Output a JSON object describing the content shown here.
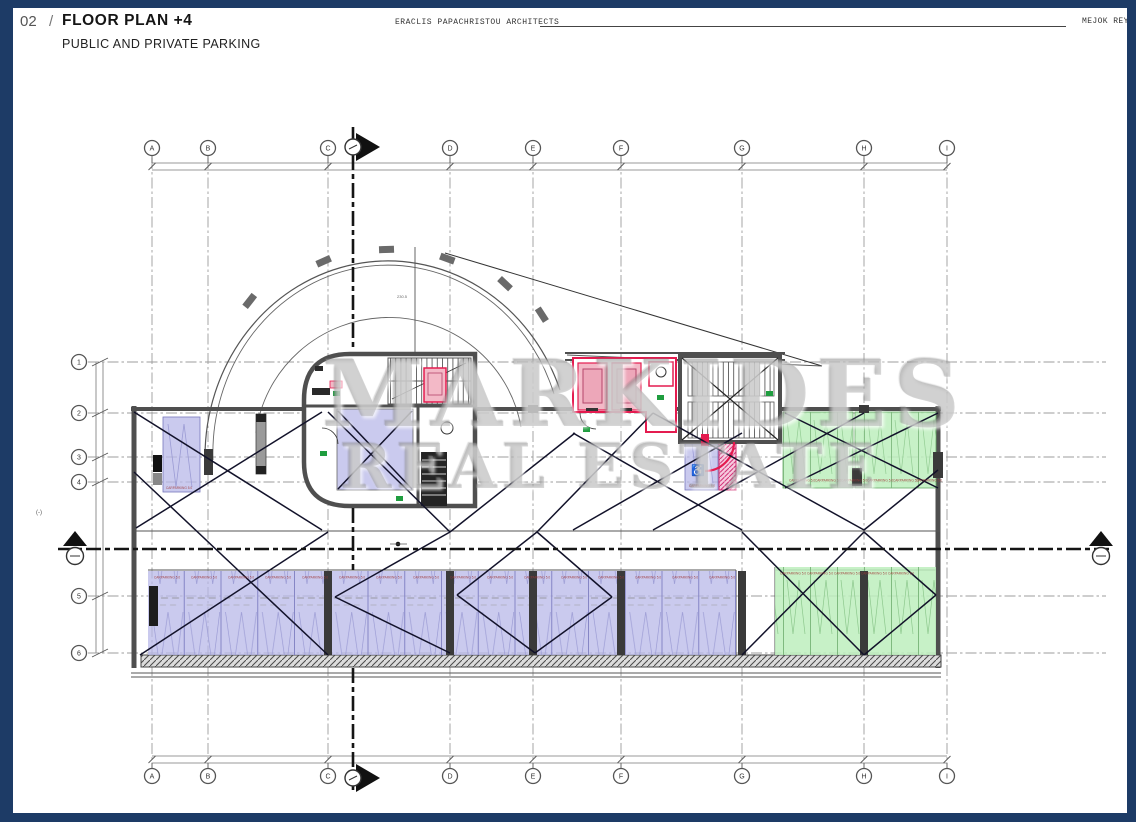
{
  "header": {
    "sheet_number": "02",
    "separator": "/",
    "title": "FLOOR PLAN +4",
    "subtitle": "PUBLIC AND PRIVATE PARKING",
    "architect": "ERACLIS PAPACHRISTOU ARCHITECTS",
    "project": "MEJOK REY"
  },
  "watermark": {
    "line1": "MARKIDES",
    "line2": "REAL ESTATE"
  },
  "grid": {
    "columns": [
      [
        "A",
        152
      ],
      [
        "B",
        208
      ],
      [
        "C",
        328
      ],
      [
        "D",
        450
      ],
      [
        "E",
        533
      ],
      [
        "F",
        621
      ],
      [
        "G",
        742
      ],
      [
        "H",
        864
      ],
      [
        "I",
        947
      ]
    ],
    "rows": [
      [
        "1",
        362
      ],
      [
        "2",
        413
      ],
      [
        "3",
        457
      ],
      [
        "4",
        482
      ],
      [
        "5",
        596
      ],
      [
        "6",
        653
      ]
    ]
  },
  "plan": {
    "stall_label": "CARPARKING 5.0",
    "ramp_dim": "230.5",
    "margin_note": "(-)",
    "bottom_stall_label_xs": [
      152,
      189,
      226,
      263,
      300,
      337,
      374,
      411,
      448,
      485,
      522,
      559,
      596,
      633,
      670,
      707
    ],
    "green_bottom_label_xs": [
      779,
      806,
      833,
      860,
      887
    ],
    "green_top_label_xs": [
      788,
      814,
      840,
      866,
      892,
      915
    ],
    "single_stall_labels": [
      [
        166,
        489
      ],
      [
        689,
        487
      ]
    ]
  },
  "icons": {
    "wheelchair": "♿"
  },
  "colors": {
    "navy": "#1d3b66",
    "lavender": "#b8b8e8",
    "green": "#bdeebd",
    "pink_fill": "#f3b9c7",
    "red": "#e41b4f",
    "magenta": "#d23378",
    "wall_gray": "#4f4f4f",
    "exit_green": "#1f9d3f",
    "watermark_gray": "#969696"
  }
}
